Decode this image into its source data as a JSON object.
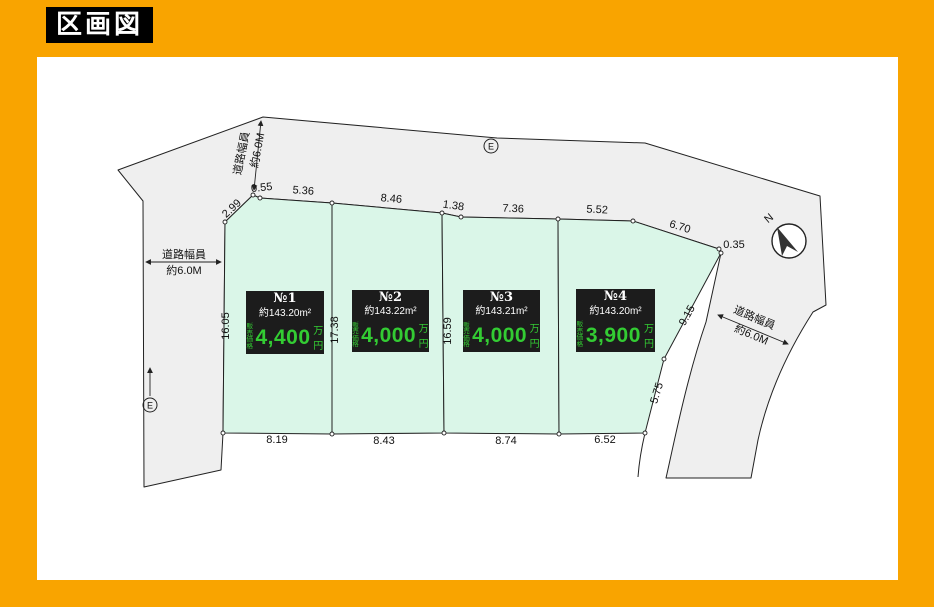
{
  "title": "区画図",
  "colors": {
    "page_bg": "#F9A400",
    "panel_bg": "#FFFFFF",
    "road_fill": "#EFEFEF",
    "lot_fill": "#DAF6E8",
    "box_bg": "#1C1C1C",
    "price_green": "#33CC33",
    "line": "#222222"
  },
  "lots": [
    {
      "no": "№1",
      "area": "約143.20m²",
      "price_label_line1": "販売",
      "price_label_line2": "価格",
      "price": "4,400",
      "price_unit": "万円"
    },
    {
      "no": "№2",
      "area": "約143.22m²",
      "price_label_line1": "販売",
      "price_label_line2": "価格",
      "price": "4,000",
      "price_unit": "万円"
    },
    {
      "no": "№3",
      "area": "約143.21m²",
      "price_label_line1": "販売",
      "price_label_line2": "価格",
      "price": "4,000",
      "price_unit": "万円"
    },
    {
      "no": "№4",
      "area": "約143.20m²",
      "price_label_line1": "販売",
      "price_label_line2": "価格",
      "price": "3,900",
      "price_unit": "万円"
    }
  ],
  "dims": {
    "top": [
      "0.55",
      "5.36",
      "8.46",
      "1.38",
      "7.36",
      "5.52",
      "6.70",
      "0.35"
    ],
    "left_slant": "2.99",
    "left_edge": "16.05",
    "dividers": [
      "17.38",
      "16.59",
      "16.24"
    ],
    "right": [
      "9.15",
      "5.75"
    ],
    "bottom": [
      "8.19",
      "8.43",
      "8.74",
      "6.52"
    ]
  },
  "roads": {
    "left": {
      "name": "道路幅員",
      "width": "約6.0M"
    },
    "top_left": {
      "name": "道路幅員",
      "width": "約6.0M"
    },
    "right": {
      "name": "道路幅員",
      "width": "約6.0M"
    }
  },
  "compass": {
    "label": "N"
  },
  "pole": {
    "label": "E"
  }
}
